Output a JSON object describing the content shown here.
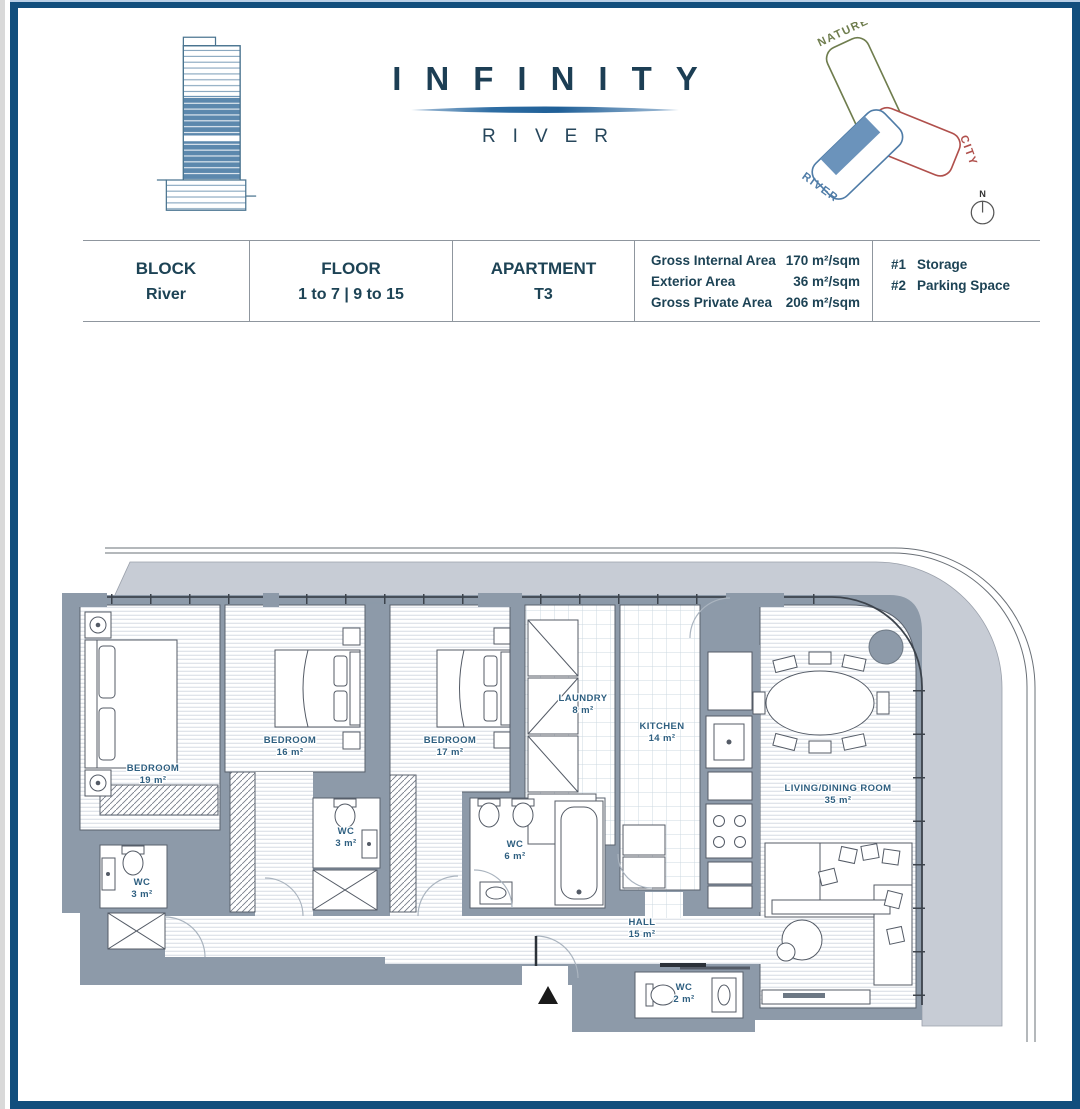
{
  "header": {
    "title": "INFINITY",
    "subtitle": "RIVER",
    "site_diagram": {
      "nature_label": "NATURE",
      "city_label": "CITY",
      "river_label": "RIVER",
      "compass_label": "N"
    }
  },
  "info_table": {
    "cells": [
      {
        "label": "BLOCK",
        "value": "River"
      },
      {
        "label": "FLOOR",
        "value": "1 to 7 | 9 to 15"
      },
      {
        "label": "APARTMENT",
        "value": "T3"
      }
    ],
    "areas": [
      {
        "label": "Gross Internal Area",
        "value": "170 m²/sqm"
      },
      {
        "label": "Exterior Area",
        "value": "36 m²/sqm"
      },
      {
        "label": "Gross Private Area",
        "value": "206 m²/sqm"
      }
    ],
    "extras": [
      {
        "num": "#1",
        "value": "Storage"
      },
      {
        "num": "#2",
        "value": "Parking Space"
      }
    ]
  },
  "floor_plan": {
    "rooms": [
      {
        "name": "BEDROOM",
        "area": "19 m²"
      },
      {
        "name": "BEDROOM",
        "area": "16 m²"
      },
      {
        "name": "BEDROOM",
        "area": "17 m²"
      },
      {
        "name": "LAUNDRY",
        "area": "8 m²"
      },
      {
        "name": "KITCHEN",
        "area": "14 m²"
      },
      {
        "name": "LIVING/DINING ROOM",
        "area": "35 m²"
      },
      {
        "name": "WC",
        "area": "3 m²"
      },
      {
        "name": "WC",
        "area": "3 m²"
      },
      {
        "name": "WC",
        "area": "6 m²"
      },
      {
        "name": "WC",
        "area": "2 m²"
      },
      {
        "name": "HALL",
        "area": "15 m²"
      }
    ]
  },
  "colors": {
    "frame": "#114e7d",
    "wall": "#8d9aa9",
    "terrace": "#c7ccd5",
    "room_label": "#2e5f80",
    "nature": "#6f7d4e",
    "city": "#b0504c",
    "river": "#4f7ca7",
    "unit_marker": "#6b93bb",
    "brand": "#1c3e54"
  }
}
